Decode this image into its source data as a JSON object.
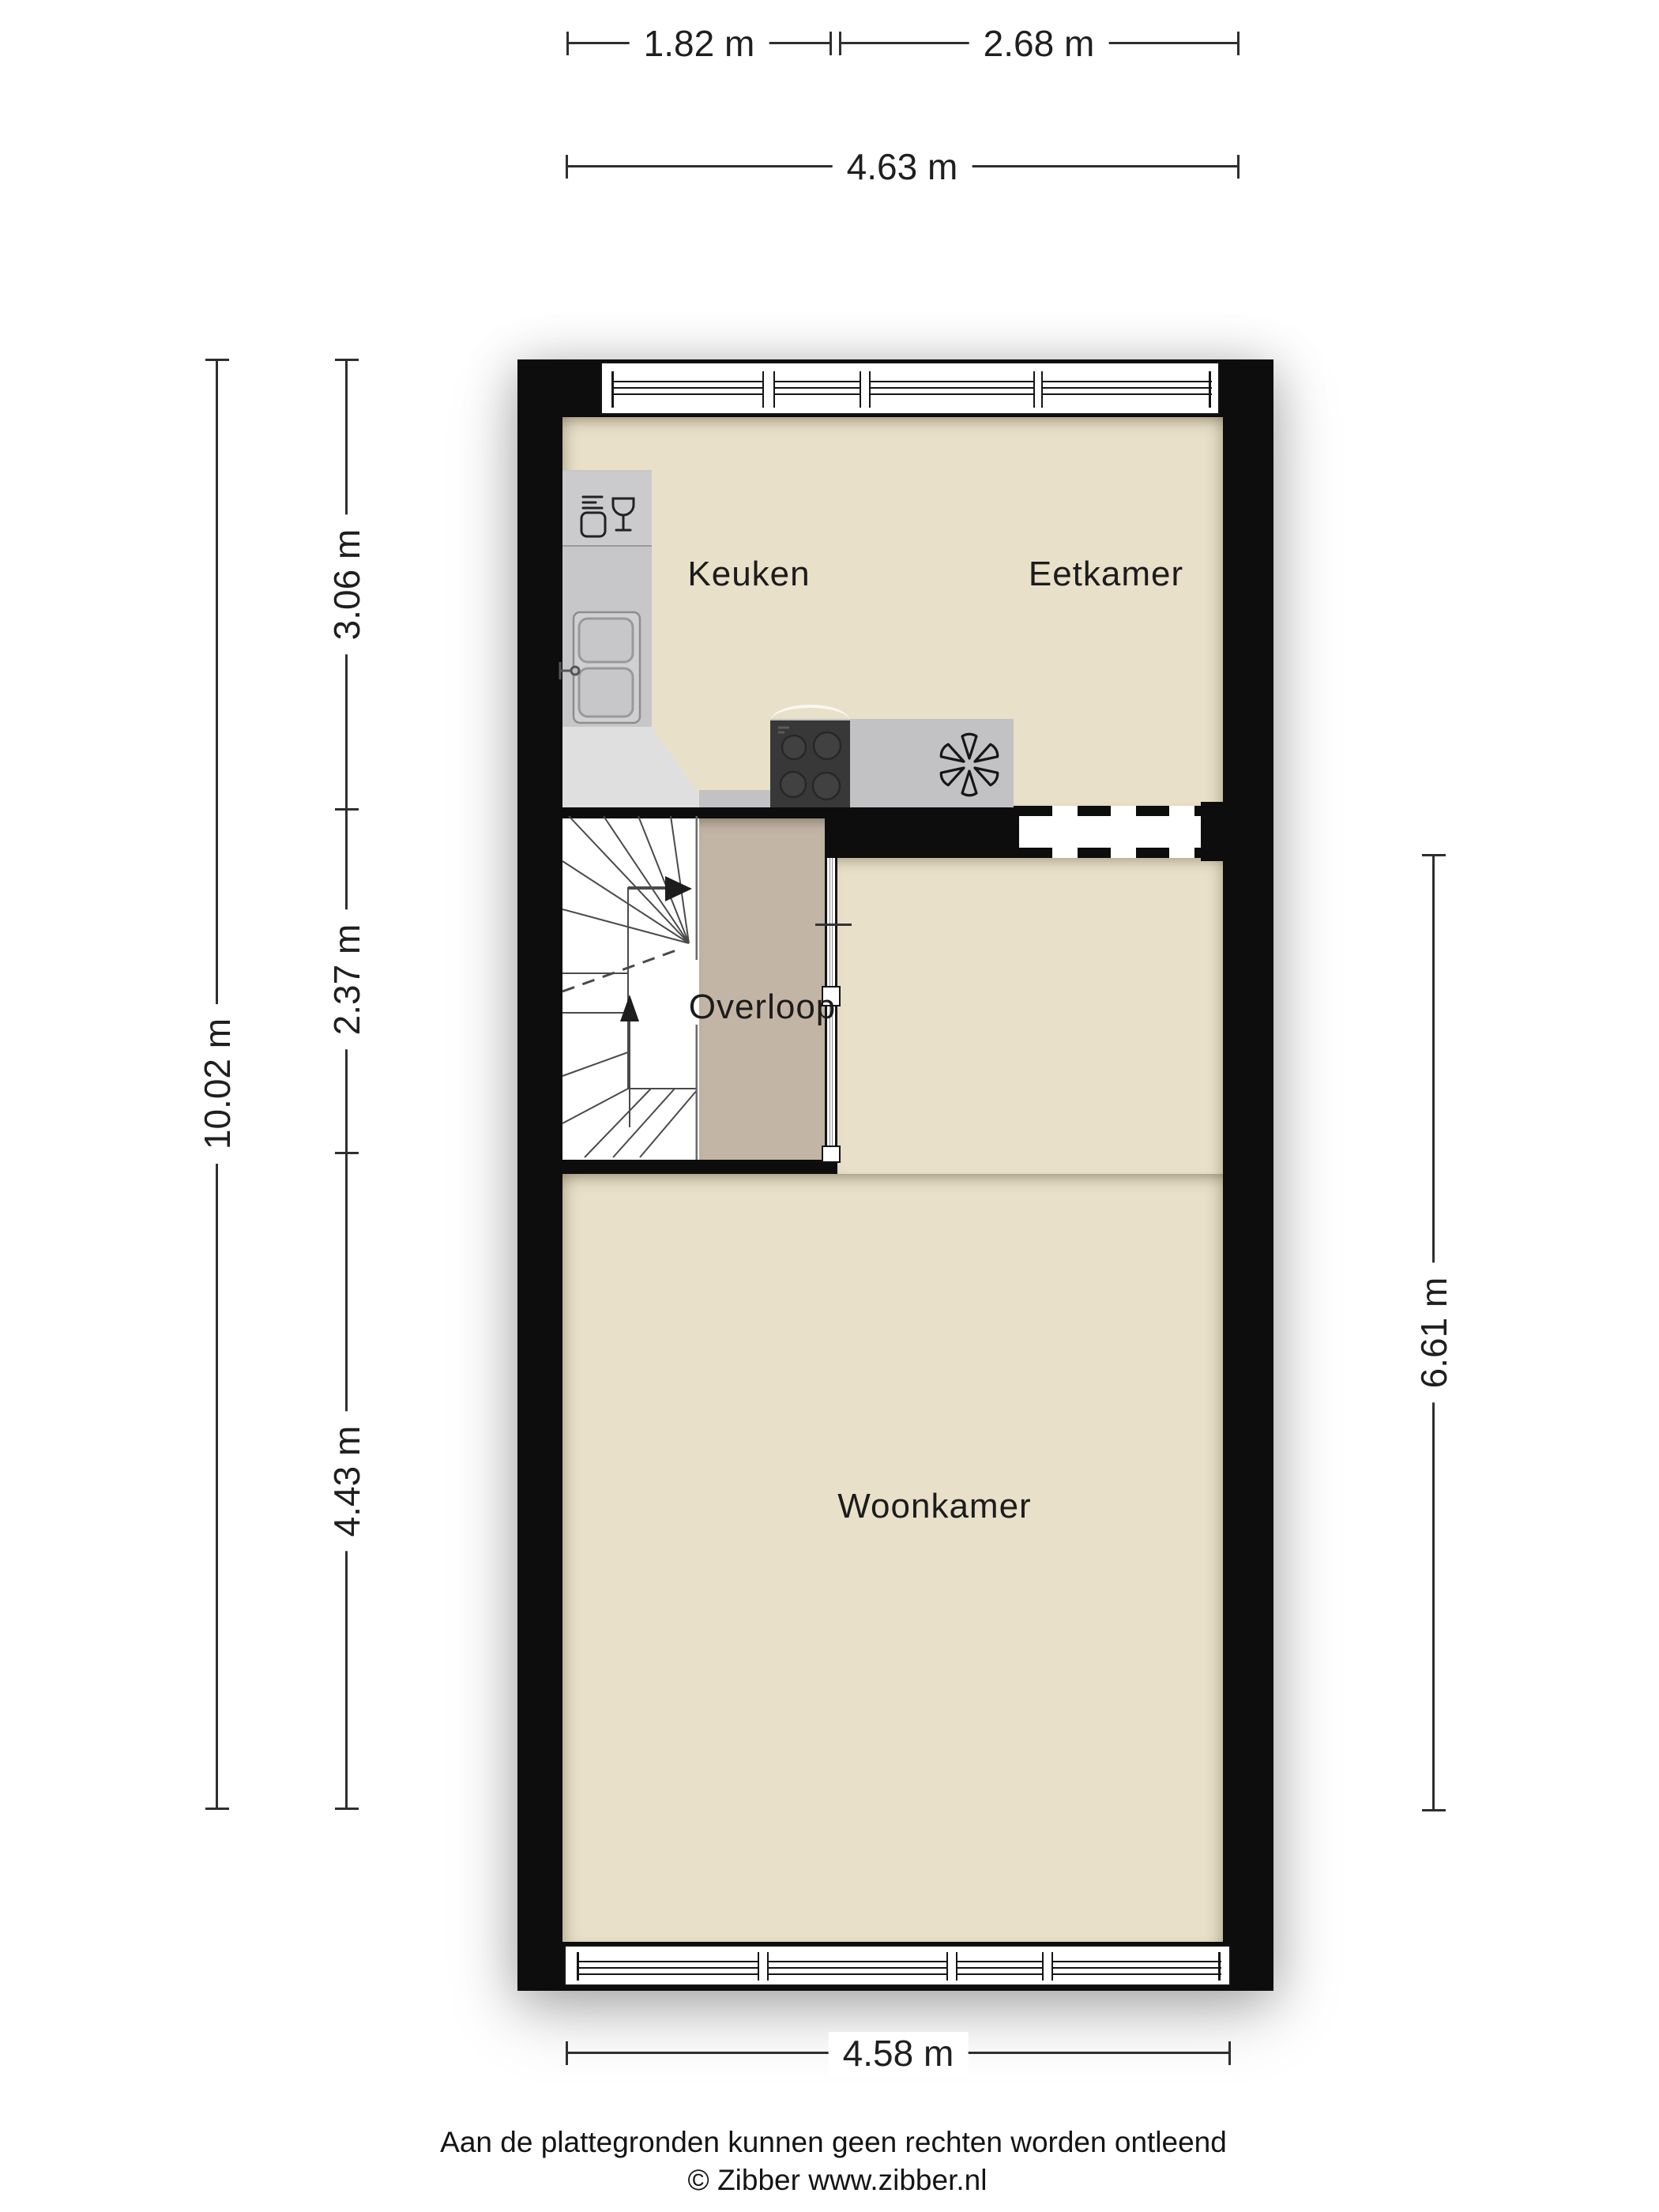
{
  "plan_title": "Begane grond plattegrond",
  "rooms": [
    {
      "name": "keuken",
      "label": "Keuken"
    },
    {
      "name": "eetkamer",
      "label": "Eetkamer"
    },
    {
      "name": "overloop",
      "label": "Overloop"
    },
    {
      "name": "woonkamer",
      "label": "Woonkamer"
    }
  ],
  "dimensions": {
    "top_row": [
      {
        "label": "1.82 m"
      },
      {
        "label": "2.68 m"
      }
    ],
    "top_total": {
      "label": "4.63 m"
    },
    "left_total": {
      "label": "10.02 m"
    },
    "left_segments": [
      {
        "label": "3.06 m"
      },
      {
        "label": "2.37 m"
      },
      {
        "label": "4.43 m"
      }
    ],
    "right": {
      "label": "6.61 m"
    },
    "bottom": {
      "label": "4.58 m"
    }
  },
  "footer": {
    "disclaimer": "Aan de plattegronden kunnen geen rechten worden ontleend",
    "copyright": "© Zibber www.zibber.nl"
  },
  "icons": [
    "dishwasher-icon",
    "sink-icon",
    "faucet-icon",
    "stove-icon",
    "extractor-arc-icon",
    "fan-symbol-icon",
    "stairs-up-arrow-icon",
    "window-glyph"
  ],
  "colors": {
    "wall": "#0d0d0d",
    "floor": "#e8e0c9",
    "overloop_floor": "#c3b5a5",
    "counter": "#c7c7c9",
    "counter_light": "#dfdfe0",
    "counter_band": "#c2c2c4",
    "stove": "#383838",
    "line": "#2f2f2f",
    "text": "#1c1c1c"
  }
}
